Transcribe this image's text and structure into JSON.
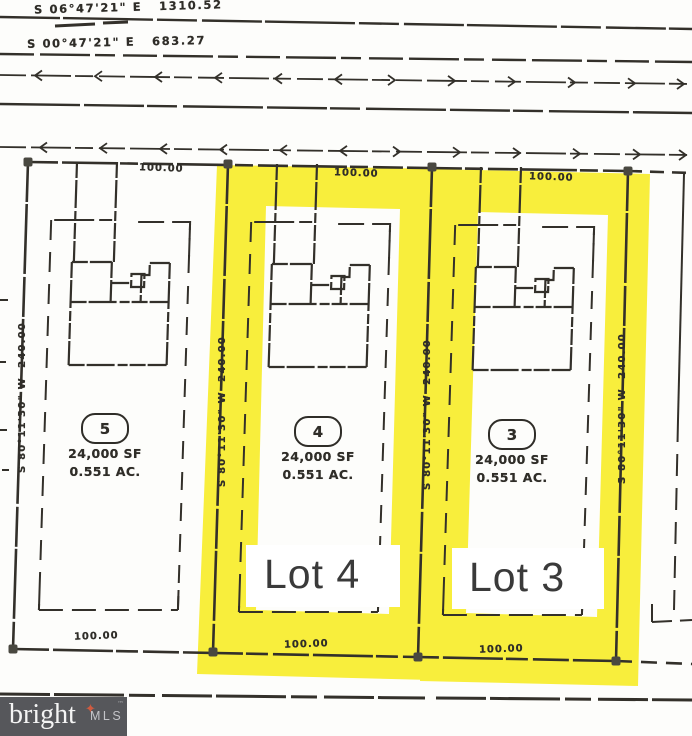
{
  "plat": {
    "street_bearings": [
      "S 06°47'21\" E   1310.52",
      "S 00°47'21\" E   683.27"
    ],
    "side_bearing": "S 80°11'30\" W  240.00",
    "frontage_dim": "100.00",
    "lots": [
      {
        "number": "5",
        "area_sf": "24,000 SF",
        "area_ac": "0.551 AC."
      },
      {
        "number": "4",
        "area_sf": "24,000 SF",
        "area_ac": "0.551 AC.",
        "highlight_label": "Lot 4"
      },
      {
        "number": "3",
        "area_sf": "24,000 SF",
        "area_ac": "0.551 AC.",
        "highlight_label": "Lot 3"
      }
    ],
    "colors": {
      "highlight": "#f8ee3c",
      "ink": "#33302a"
    }
  },
  "watermark": {
    "brand": "bright",
    "star": "✦",
    "tm": "™",
    "suffix": "MLS"
  }
}
